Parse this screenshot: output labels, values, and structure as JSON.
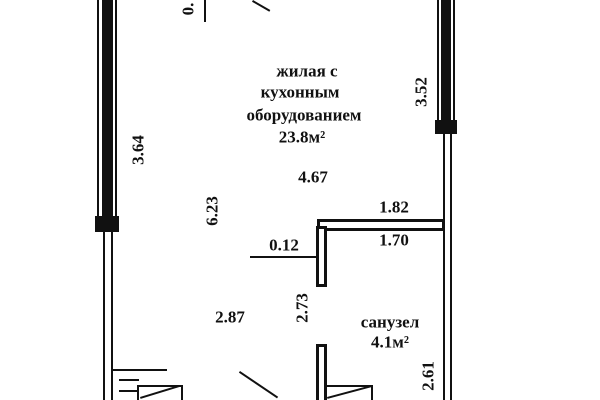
{
  "rooms": {
    "living": {
      "line1": "жилая с",
      "line2": "кухонным",
      "line3": "оборудованием",
      "area": "23.8м²"
    },
    "bathroom": {
      "name": "санузел",
      "area": "4.1м²"
    }
  },
  "dimensions": {
    "top_cut": "0.",
    "left_outer": "3.64",
    "left_inner": "6.23",
    "right_outer": "3.52",
    "living_width": "4.67",
    "partition_above": "1.82",
    "partition_below": "1.70",
    "partition_thickness": "0.12",
    "bath_left": "2.73",
    "bottom_width": "2.87",
    "bath_right": "2.61"
  },
  "colors": {
    "line": "#111111",
    "background": "#ffffff"
  }
}
